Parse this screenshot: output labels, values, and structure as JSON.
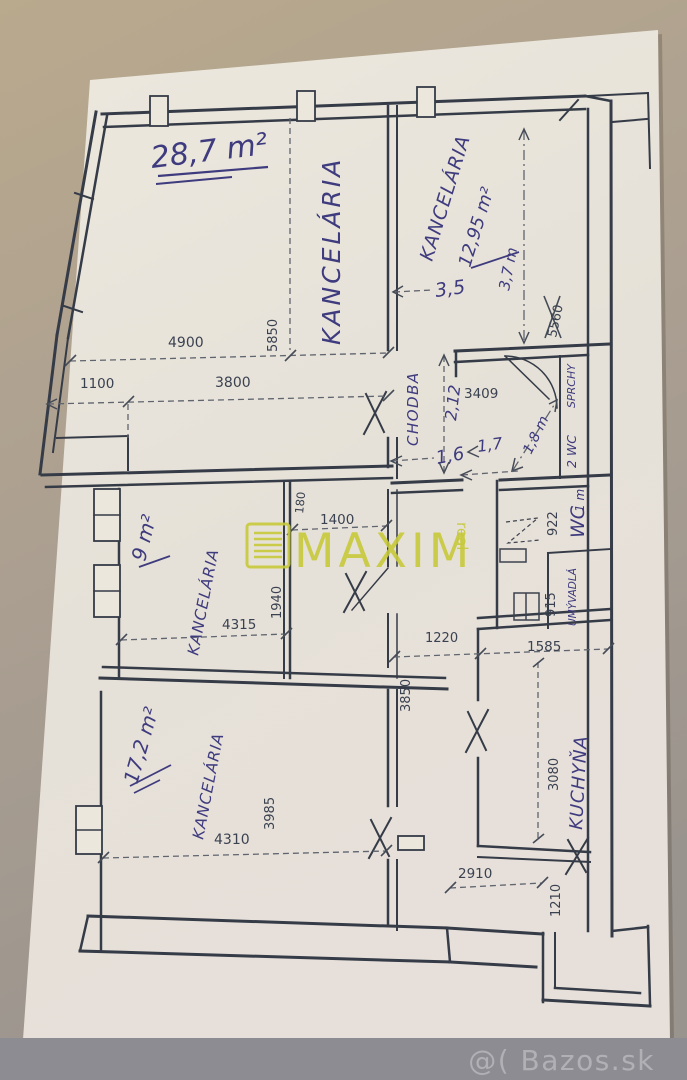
{
  "photo": {
    "bazos_watermark": "@( Bazos.sk",
    "maxim": {
      "brand": "MAXIM",
      "brand_sub": "real"
    }
  },
  "colors": {
    "maxim_yellow": "#c6c93a",
    "handwriting_ink": "#3e3b7e",
    "drawing_ink": "#353b47",
    "paper": "#eae6dc"
  },
  "plan": {
    "rooms": {
      "office_large": {
        "label": "KANCELÁRIA",
        "area": "28,7 m²"
      },
      "office_top_right": {
        "label": "KANCELÁRIA",
        "area": "12,95 m²"
      },
      "office_middle": {
        "label": "KANCELÁRIA",
        "area": "9 m²"
      },
      "office_bottom": {
        "label": "KANCELÁRIA",
        "area": "17,2 m²"
      },
      "hallway": {
        "label": "CHODBA"
      },
      "kitchen": {
        "label": "KUCHYŇA"
      },
      "wc": {
        "label": "WC"
      },
      "wc2": {
        "label": "2 WC"
      },
      "washbasins": {
        "label": "UMÝVADLÁ"
      },
      "showers": {
        "label": "SPRCHY"
      }
    },
    "dims_printed": {
      "w4900": "4900",
      "w5850": "5850",
      "w1100": "1100",
      "w3800": "3800",
      "w3409": "3409",
      "w5560": "5560",
      "w1400": "1400",
      "w180": "180",
      "w1940": "1940",
      "w4315": "4315",
      "w922": "922",
      "w915": "915",
      "w1220": "1220",
      "w1585": "1585",
      "w3850": "3850",
      "w3985": "3985",
      "w4310": "4310",
      "w3080": "3080",
      "w2910": "2910",
      "w1210": "1210"
    },
    "dims_hand": {
      "h35": "3,5",
      "h37": "3,7 m",
      "h212": "2,12",
      "h16": "1,6",
      "h17": "1,7",
      "h18": "1,8 m",
      "h1m": "1 m"
    }
  }
}
